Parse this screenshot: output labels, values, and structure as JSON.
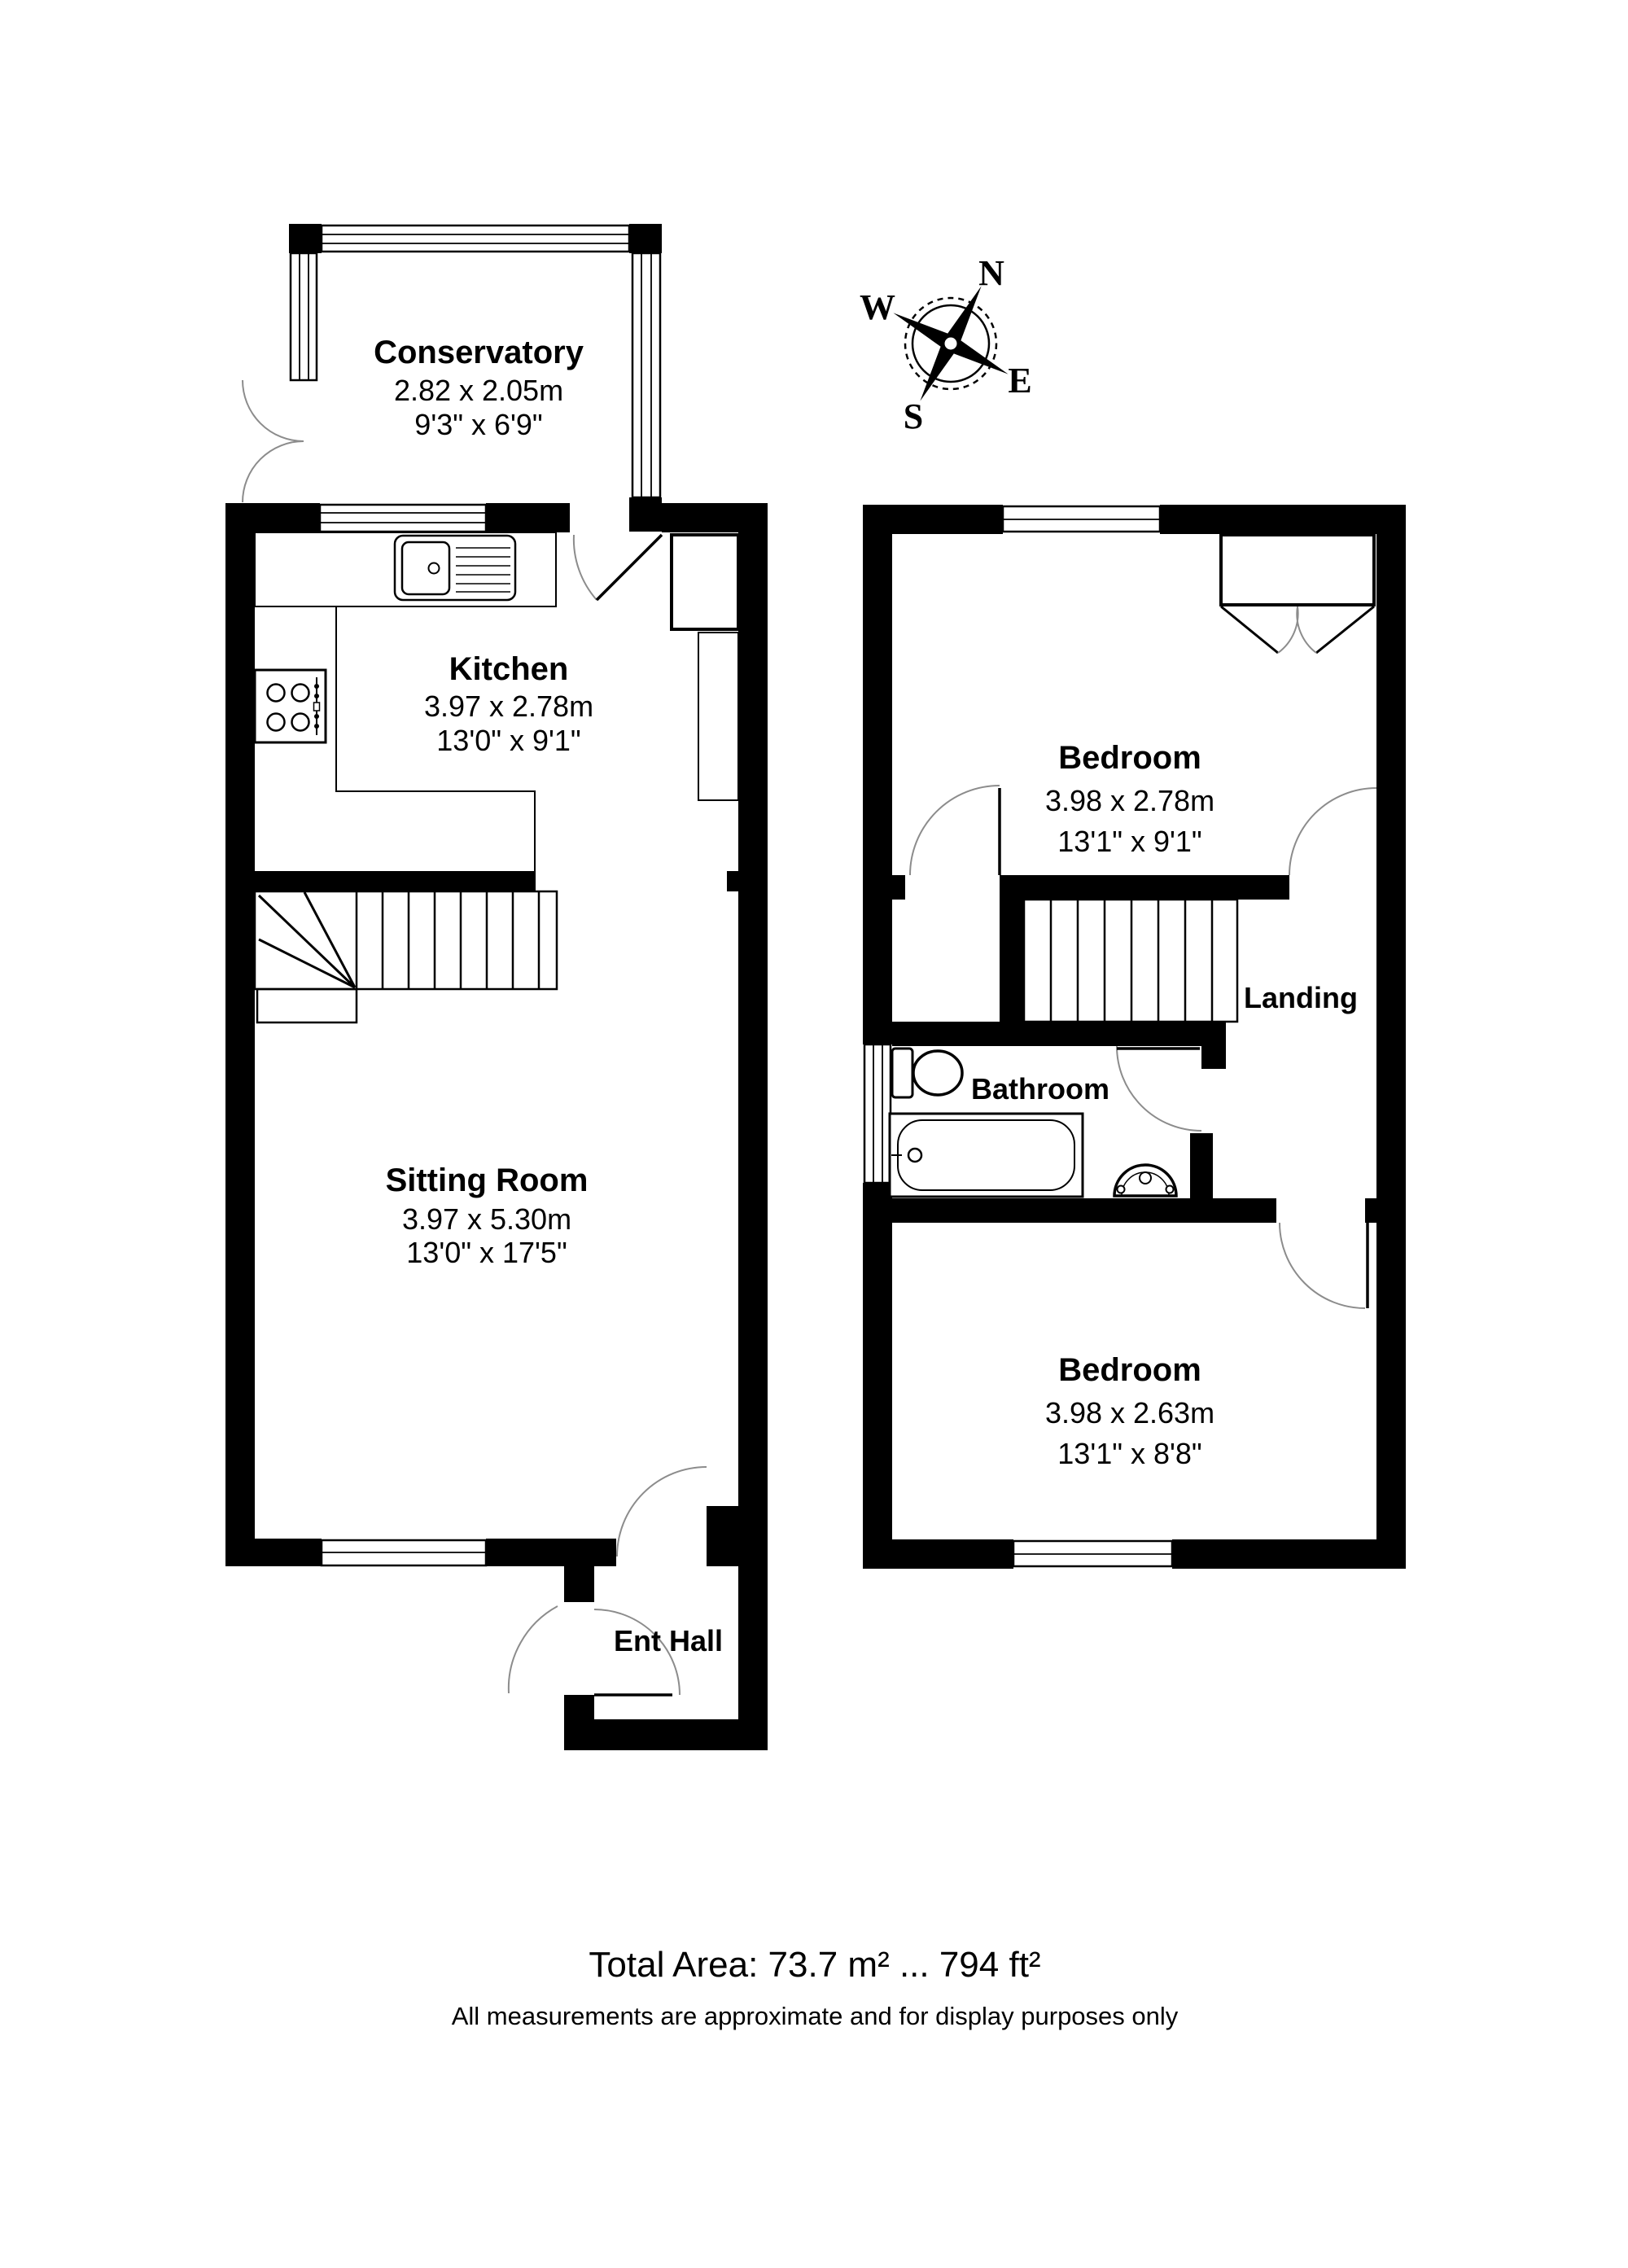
{
  "compass": {
    "north": "N",
    "east": "E",
    "south": "S",
    "west": "W"
  },
  "ground_floor": {
    "conservatory": {
      "name": "Conservatory",
      "metric": "2.82 x 2.05m",
      "imperial": "9'3\" x 6'9\""
    },
    "kitchen": {
      "name": "Kitchen",
      "metric": "3.97 x 2.78m",
      "imperial": "13'0\" x 9'1\""
    },
    "sitting_room": {
      "name": "Sitting Room",
      "metric": "3.97 x 5.30m",
      "imperial": "13'0\" x 17'5\""
    },
    "ent_hall": {
      "name": "Ent Hall"
    }
  },
  "first_floor": {
    "bedroom_1": {
      "name": "Bedroom",
      "metric": "3.98 x 2.78m",
      "imperial": "13'1\" x 9'1\""
    },
    "landing": {
      "name": "Landing"
    },
    "bathroom": {
      "name": "Bathroom"
    },
    "bedroom_2": {
      "name": "Bedroom",
      "metric": "3.98 x 2.63m",
      "imperial": "13'1\" x 8'8\""
    }
  },
  "footer": {
    "total_area": "Total Area: 73.7 m² ... 794 ft²",
    "disclaimer": "All measurements are approximate and for display purposes only"
  },
  "colors": {
    "wall": "#000000",
    "background": "#ffffff",
    "door_arc": "#8c8c8c"
  }
}
